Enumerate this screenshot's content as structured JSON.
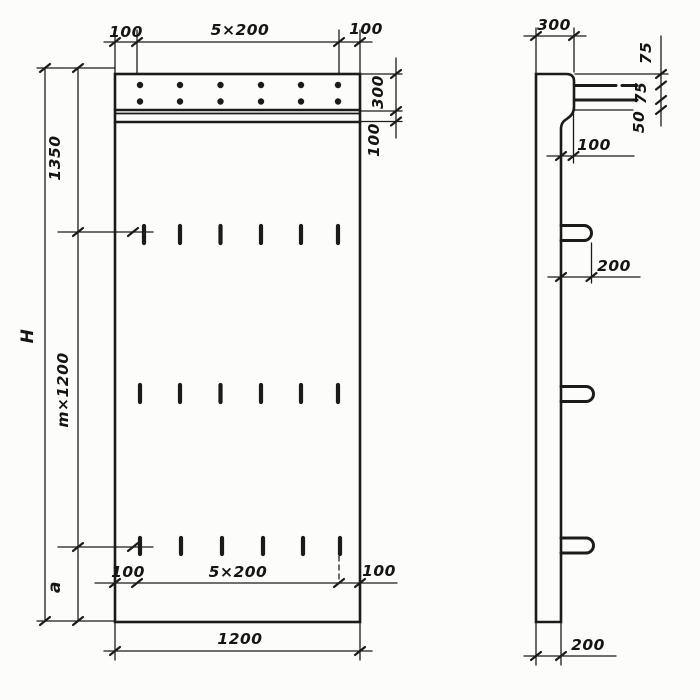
{
  "page": {
    "background": "#fcfcfa",
    "ink": "#1b1b1b"
  },
  "front_view": {
    "title": "panel front view",
    "top_dimension": {
      "left": "100",
      "center": "5×200",
      "right": "100"
    },
    "right_dimension": {
      "top": "300",
      "bottom": "100"
    },
    "left_dimension": {
      "overall": "H",
      "upper": "1350",
      "middle": "m×1200",
      "lower": "a"
    },
    "lower_inner_dimension": {
      "left": "100",
      "center": "5×200",
      "right": "100"
    },
    "bottom_dimension": {
      "width": "1200"
    }
  },
  "side_view": {
    "title": "panel side view",
    "top_dimension": {
      "width": "300"
    },
    "right_dimension": {
      "top": "75",
      "middle": "75",
      "bottom": "50"
    },
    "flange_dimension": {
      "offset": "100"
    },
    "loop_dimension": {
      "offset": "200"
    },
    "bottom_dimension": {
      "thickness": "200"
    }
  }
}
